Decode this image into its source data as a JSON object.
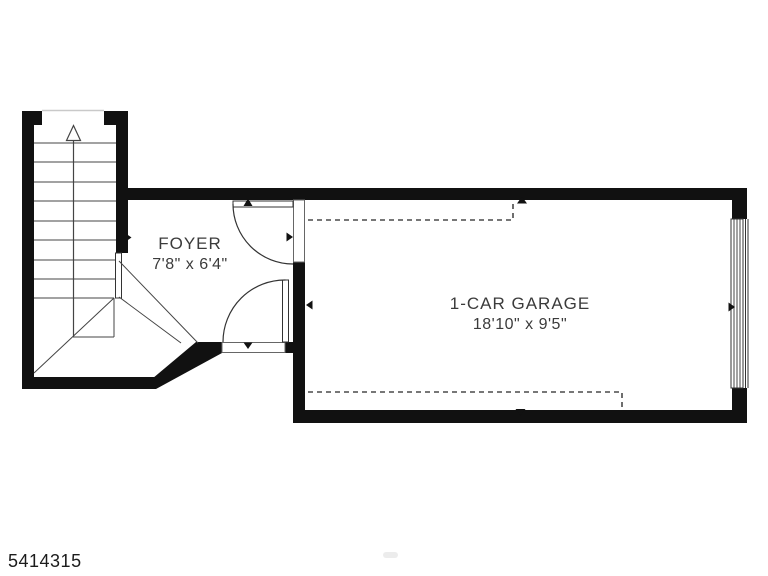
{
  "plan": {
    "type": "floor-plan",
    "rooms": [
      {
        "name": "FOYER",
        "dimensions": "7'8\" x 6'4\""
      },
      {
        "name": "1-CAR GARAGE",
        "dimensions": "18'10\" x 9'5\""
      }
    ],
    "stairs": {
      "direction": "up",
      "treads": 9,
      "turn": "winder-bottom"
    },
    "doors": [
      {
        "between": "foyer-garage",
        "swing": "into-foyer-toward-north-wall"
      },
      {
        "between": "foyer-exterior",
        "swing": "into-foyer-hinged-east"
      },
      {
        "between": "garage-exterior",
        "kind": "overhead-garage-door"
      }
    ],
    "photo_id": "5414315",
    "colors": {
      "wall": "#111111",
      "line": "#3c3c3c",
      "dashed_line": "#4a4a4a",
      "text": "#3b3b3b",
      "background": "#ffffff"
    }
  }
}
